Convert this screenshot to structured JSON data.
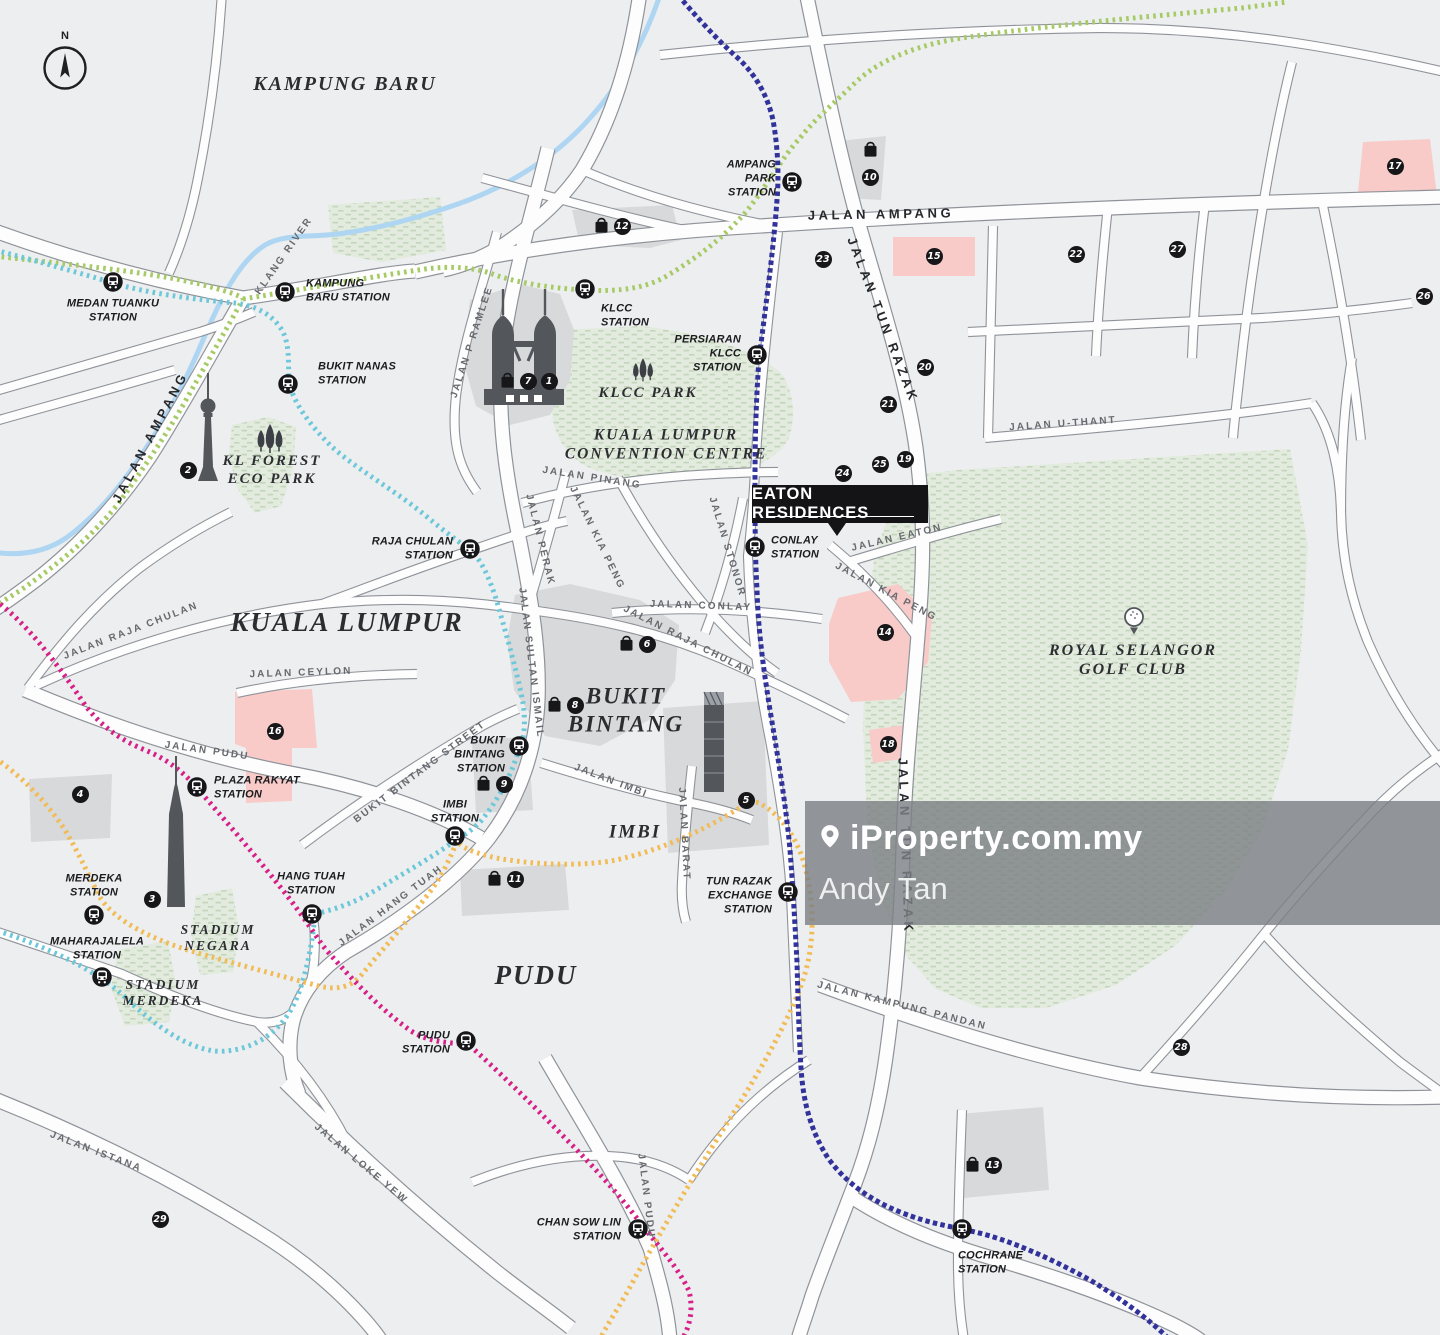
{
  "map": {
    "background": "#edeef0",
    "property_label": "EATON RESIDENCES",
    "compass": {
      "label": "N"
    },
    "watermark": {
      "brand": "iProperty.com.my",
      "agent": "Andy Tan",
      "pin_icon": "location-pin-icon"
    },
    "colors": {
      "road_fill": "#fdfdfe",
      "road_casing": "#8f9399",
      "building": "#d8d9db",
      "landmark_dark": "#53575c",
      "park_green": "#e2ebdd",
      "park_dash": "#c3d6bc",
      "highlight_pink": "#f8cbc8",
      "river_blue": "#aed6f2",
      "marker_black": "#17171a",
      "label_gray": "#67696e",
      "label_dark": "#27282c",
      "watermark_bg": "rgba(124,128,133,0.82)"
    },
    "icons": [
      "compass-icon",
      "train-station-icon",
      "shopping-bag-icon",
      "petronas-towers-icon",
      "kl-tower-icon",
      "merdeka-118-tower-icon",
      "exchange-106-tower-icon",
      "park-trees-icon",
      "golf-ball-icon",
      "location-pin-icon"
    ],
    "transit_lines": [
      {
        "name": "green-line",
        "color": "#a6ca64"
      },
      {
        "name": "cyan-line",
        "color": "#6cc8d9"
      },
      {
        "name": "navy-line",
        "color": "#32329b"
      },
      {
        "name": "magenta-line",
        "color": "#d61f87"
      },
      {
        "name": "orange-line",
        "color": "#f1bb55"
      }
    ],
    "stations": [
      {
        "id": "medan-tuanku",
        "lines": [
          "MEDAN TUANKU",
          "STATION"
        ],
        "x": 113,
        "y": 282,
        "lx": 113,
        "ly": 311,
        "align": "center"
      },
      {
        "id": "kampung-baru",
        "lines": [
          "KAMPUNG",
          "BARU STATION"
        ],
        "x": 285,
        "y": 292,
        "lx": 306,
        "ly": 291,
        "align": "left"
      },
      {
        "id": "bukit-nanas",
        "lines": [
          "BUKIT NANAS",
          "STATION"
        ],
        "x": 288,
        "y": 384,
        "lx": 318,
        "ly": 374,
        "align": "left"
      },
      {
        "id": "klcc",
        "lines": [
          "KLCC",
          "STATION"
        ],
        "x": 585,
        "y": 289,
        "lx": 601,
        "ly": 316,
        "align": "left"
      },
      {
        "id": "ampang-park",
        "lines": [
          "AMPANG",
          "PARK",
          "STATION"
        ],
        "x": 792,
        "y": 182,
        "lx": 776,
        "ly": 179,
        "align": "right"
      },
      {
        "id": "persiaran-klcc",
        "lines": [
          "PERSIARAN",
          "KLCC",
          "STATION"
        ],
        "x": 757,
        "y": 355,
        "lx": 741,
        "ly": 354,
        "align": "right"
      },
      {
        "id": "raja-chulan",
        "lines": [
          "RAJA CHULAN",
          "STATION"
        ],
        "x": 470,
        "y": 549,
        "lx": 453,
        "ly": 549,
        "align": "right"
      },
      {
        "id": "conlay",
        "lines": [
          "CONLAY",
          "STATION"
        ],
        "x": 755,
        "y": 547,
        "lx": 771,
        "ly": 548,
        "align": "left"
      },
      {
        "id": "bukit-bintang",
        "lines": [
          "BUKIT",
          "BINTANG",
          "STATION"
        ],
        "x": 519,
        "y": 746,
        "lx": 505,
        "ly": 755,
        "align": "right"
      },
      {
        "id": "imbi",
        "lines": [
          "IMBI",
          "STATION"
        ],
        "x": 455,
        "y": 836,
        "lx": 455,
        "ly": 812,
        "align": "center"
      },
      {
        "id": "plaza-rakyat",
        "lines": [
          "PLAZA RAKYAT",
          "STATION"
        ],
        "x": 197,
        "y": 787,
        "lx": 214,
        "ly": 788,
        "align": "left"
      },
      {
        "id": "merdeka",
        "lines": [
          "MERDEKA",
          "STATION"
        ],
        "x": 94,
        "y": 915,
        "lx": 94,
        "ly": 886,
        "align": "center"
      },
      {
        "id": "maharajalela",
        "lines": [
          "MAHARAJALELA",
          "STATION"
        ],
        "x": 102,
        "y": 977,
        "lx": 97,
        "ly": 949,
        "align": "center"
      },
      {
        "id": "hang-tuah",
        "lines": [
          "HANG TUAH",
          "STATION"
        ],
        "x": 312,
        "y": 914,
        "lx": 311,
        "ly": 884,
        "align": "center"
      },
      {
        "id": "pudu",
        "lines": [
          "PUDU",
          "STATION"
        ],
        "x": 466,
        "y": 1041,
        "lx": 450,
        "ly": 1043,
        "align": "right"
      },
      {
        "id": "tun-razak-exchange",
        "lines": [
          "TUN RAZAK",
          "EXCHANGE",
          "STATION"
        ],
        "x": 788,
        "y": 892,
        "lx": 772,
        "ly": 896,
        "align": "right"
      },
      {
        "id": "chan-sow-lin",
        "lines": [
          "CHAN SOW LIN",
          "STATION"
        ],
        "x": 638,
        "y": 1229,
        "lx": 621,
        "ly": 1230,
        "align": "right"
      },
      {
        "id": "cochrane",
        "lines": [
          "COCHRANE",
          "STATION"
        ],
        "x": 962,
        "y": 1229,
        "lx": 958,
        "ly": 1263,
        "align": "left"
      }
    ],
    "markers": [
      {
        "n": "1",
        "x": 549,
        "y": 381,
        "bag": false
      },
      {
        "n": "2",
        "x": 188,
        "y": 470,
        "bag": false
      },
      {
        "n": "3",
        "x": 152,
        "y": 899,
        "bag": false
      },
      {
        "n": "4",
        "x": 80,
        "y": 794,
        "bag": false
      },
      {
        "n": "5",
        "x": 746,
        "y": 800,
        "bag": false
      },
      {
        "n": "6",
        "x": 647,
        "y": 644,
        "bag": true
      },
      {
        "n": "7",
        "x": 528,
        "y": 381,
        "bag": true
      },
      {
        "n": "8",
        "x": 575,
        "y": 705,
        "bag": true
      },
      {
        "n": "9",
        "x": 504,
        "y": 784,
        "bag": true
      },
      {
        "n": "10",
        "x": 870,
        "y": 177,
        "bag": true,
        "bag_pos": "above"
      },
      {
        "n": "11",
        "x": 515,
        "y": 879,
        "bag": true
      },
      {
        "n": "12",
        "x": 622,
        "y": 226,
        "bag": true
      },
      {
        "n": "13",
        "x": 993,
        "y": 1165,
        "bag": true
      },
      {
        "n": "14",
        "x": 885,
        "y": 632,
        "bag": false
      },
      {
        "n": "15",
        "x": 934,
        "y": 256,
        "bag": false
      },
      {
        "n": "16",
        "x": 275,
        "y": 731,
        "bag": false
      },
      {
        "n": "17",
        "x": 1395,
        "y": 166,
        "bag": false
      },
      {
        "n": "18",
        "x": 888,
        "y": 744,
        "bag": false
      },
      {
        "n": "19",
        "x": 905,
        "y": 459,
        "bag": false
      },
      {
        "n": "20",
        "x": 925,
        "y": 367,
        "bag": false
      },
      {
        "n": "21",
        "x": 888,
        "y": 404,
        "bag": false
      },
      {
        "n": "22",
        "x": 1076,
        "y": 254,
        "bag": false
      },
      {
        "n": "23",
        "x": 823,
        "y": 259,
        "bag": false
      },
      {
        "n": "24",
        "x": 843,
        "y": 473,
        "bag": false
      },
      {
        "n": "25",
        "x": 880,
        "y": 464,
        "bag": false
      },
      {
        "n": "26",
        "x": 1424,
        "y": 296,
        "bag": false
      },
      {
        "n": "27",
        "x": 1177,
        "y": 249,
        "bag": false
      },
      {
        "n": "28",
        "x": 1181,
        "y": 1047,
        "bag": false
      },
      {
        "n": "29",
        "x": 160,
        "y": 1219,
        "bag": false
      }
    ],
    "road_labels": [
      {
        "text": "JALAN AMPANG",
        "x": 881,
        "y": 214,
        "rot": -1,
        "cls": "main"
      },
      {
        "text": "JALAN AMPANG",
        "x": 150,
        "y": 437,
        "rot": -62,
        "cls": "main"
      },
      {
        "text": "JALAN TUN RAZAK",
        "x": 883,
        "y": 320,
        "rot": 69,
        "cls": "main"
      },
      {
        "text": "JALAN TUN RAZAK",
        "x": 906,
        "y": 846,
        "rot": 88,
        "cls": "main"
      },
      {
        "text": "KLANG RIVER",
        "x": 284,
        "y": 256,
        "rot": -55,
        "cls": "minor"
      },
      {
        "text": "JALAN U-THANT",
        "x": 1063,
        "y": 424,
        "rot": -4,
        "cls": "minor"
      },
      {
        "text": "JALAN P RAMLEE",
        "x": 472,
        "y": 342,
        "rot": -72,
        "cls": "minor"
      },
      {
        "text": "JALAN PINANG",
        "x": 592,
        "y": 478,
        "rot": 9,
        "cls": "minor"
      },
      {
        "text": "JALAN PERAK",
        "x": 540,
        "y": 540,
        "rot": 76,
        "cls": "minor"
      },
      {
        "text": "JALAN KIA PENG",
        "x": 597,
        "y": 538,
        "rot": 64,
        "cls": "minor"
      },
      {
        "text": "JALAN KIA PENG",
        "x": 886,
        "y": 592,
        "rot": 28,
        "cls": "minor"
      },
      {
        "text": "JALAN STONOR",
        "x": 727,
        "y": 547,
        "rot": 73,
        "cls": "minor"
      },
      {
        "text": "JALAN CONLAY",
        "x": 701,
        "y": 606,
        "rot": 2,
        "cls": "minor"
      },
      {
        "text": "JALAN EATON",
        "x": 897,
        "y": 538,
        "rot": -13,
        "cls": "minor"
      },
      {
        "text": "JALAN RAJA CHULAN",
        "x": 131,
        "y": 631,
        "rot": -21,
        "cls": "minor"
      },
      {
        "text": "JALAN RAJA CHULAN",
        "x": 688,
        "y": 641,
        "rot": 27,
        "cls": "minor"
      },
      {
        "text": "JALAN CEYLON",
        "x": 301,
        "y": 673,
        "rot": -2,
        "cls": "minor"
      },
      {
        "text": "JALAN PUDU",
        "x": 207,
        "y": 751,
        "rot": 8,
        "cls": "minor"
      },
      {
        "text": "JALAN PUDU",
        "x": 646,
        "y": 1196,
        "rot": 83,
        "cls": "minor"
      },
      {
        "text": "BUKIT BINTANG STREET",
        "x": 420,
        "y": 772,
        "rot": -37,
        "cls": "minor"
      },
      {
        "text": "JALAN SULTAN ISMAIL",
        "x": 531,
        "y": 663,
        "rot": 83,
        "cls": "minor"
      },
      {
        "text": "JALAN IMBI",
        "x": 611,
        "y": 781,
        "rot": 21,
        "cls": "minor"
      },
      {
        "text": "JALAN BARAT",
        "x": 684,
        "y": 834,
        "rot": 87,
        "cls": "minor"
      },
      {
        "text": "JALAN HANG TUAH",
        "x": 391,
        "y": 906,
        "rot": -37,
        "cls": "minor"
      },
      {
        "text": "JALAN ISTANA",
        "x": 96,
        "y": 1152,
        "rot": 21,
        "cls": "minor"
      },
      {
        "text": "JALAN LOKE YEW",
        "x": 361,
        "y": 1164,
        "rot": 40,
        "cls": "minor"
      },
      {
        "text": "JALAN KAMPUNG PANDAN",
        "x": 902,
        "y": 1006,
        "rot": 14,
        "cls": "minor"
      }
    ],
    "area_labels": [
      {
        "lines": [
          "KAMPUNG BARU"
        ],
        "x": 345,
        "y": 84,
        "size": 20
      },
      {
        "lines": [
          "KUALA LUMPUR"
        ],
        "x": 347,
        "y": 622,
        "size": 27
      },
      {
        "lines": [
          "BUKIT",
          "BINTANG"
        ],
        "x": 626,
        "y": 710,
        "size": 23
      },
      {
        "lines": [
          "IMBI"
        ],
        "x": 635,
        "y": 833,
        "size": 19
      },
      {
        "lines": [
          "PUDU"
        ],
        "x": 536,
        "y": 975,
        "size": 27
      },
      {
        "lines": [
          "KLCC PARK"
        ],
        "x": 648,
        "y": 393,
        "size": 15
      },
      {
        "lines": [
          "KL FORE­ST",
          "ECO PARK"
        ],
        "x": 272,
        "y": 470,
        "size": 15
      },
      {
        "lines": [
          "KUALA LUMPUR",
          "CONVENTION CENTRE"
        ],
        "x": 666,
        "y": 445,
        "size": 15.5
      },
      {
        "lines": [
          "ROYAL SELANGOR",
          "GOLF CLUB"
        ],
        "x": 1133,
        "y": 660,
        "size": 16
      },
      {
        "lines": [
          "STADIUM",
          "NEGARA"
        ],
        "x": 218,
        "y": 938,
        "size": 13.5
      },
      {
        "lines": [
          "STADIUM",
          "MERDEKA"
        ],
        "x": 163,
        "y": 993,
        "size": 13.5
      }
    ]
  }
}
